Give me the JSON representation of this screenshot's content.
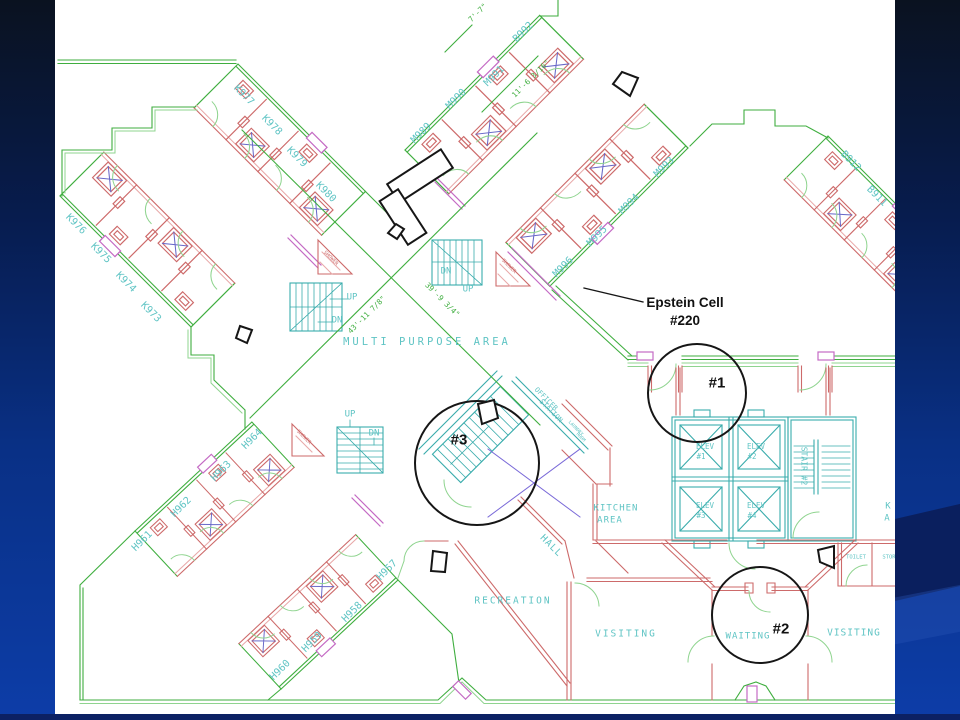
{
  "slide": {
    "bg_top": "#0a1220",
    "bg_mid": "#093085",
    "bg_bottom": "#0d3da8",
    "bottom_strip": "#0c2164",
    "plan_bg": "#ffffff"
  },
  "palette": {
    "cyan": "#5fc4c4",
    "red": "#cd6a6a",
    "green": "#3fae3f",
    "black": "#161616"
  },
  "annotations": {
    "epstein_line1": "Epstein Cell",
    "epstein_line2": "#220",
    "circle1_label": "#1",
    "circle2_label": "#2",
    "circle3_label": "#3"
  },
  "plan": {
    "labels": [
      {
        "t": "K977",
        "x": 244,
        "y": 95,
        "r": 45,
        "s": 10,
        "c": "cyan"
      },
      {
        "t": "K978",
        "x": 272,
        "y": 125,
        "r": 45,
        "s": 10,
        "c": "cyan"
      },
      {
        "t": "K979",
        "x": 297,
        "y": 157,
        "r": 45,
        "s": 10,
        "c": "cyan"
      },
      {
        "t": "K980",
        "x": 326,
        "y": 192,
        "r": 45,
        "s": 10,
        "c": "cyan"
      },
      {
        "t": "K976",
        "x": 76,
        "y": 224,
        "r": 45,
        "s": 10,
        "c": "cyan"
      },
      {
        "t": "K975",
        "x": 101,
        "y": 253,
        "r": 45,
        "s": 10,
        "c": "cyan"
      },
      {
        "t": "K974",
        "x": 126,
        "y": 282,
        "r": 45,
        "s": 10,
        "c": "cyan"
      },
      {
        "t": "K973",
        "x": 151,
        "y": 312,
        "r": 45,
        "s": 10,
        "c": "cyan"
      },
      {
        "t": "M989",
        "x": 421,
        "y": 133,
        "r": -45,
        "s": 10,
        "c": "cyan"
      },
      {
        "t": "M990",
        "x": 456,
        "y": 99,
        "r": -45,
        "s": 10,
        "c": "cyan"
      },
      {
        "t": "M991",
        "x": 494,
        "y": 76,
        "r": -45,
        "s": 10,
        "c": "cyan"
      },
      {
        "t": "B992",
        "x": 523,
        "y": 32,
        "r": -45,
        "s": 10,
        "c": "cyan"
      },
      {
        "t": "M993",
        "x": 664,
        "y": 167,
        "r": -45,
        "s": 10,
        "c": "cyan"
      },
      {
        "t": "M994",
        "x": 629,
        "y": 204,
        "r": -45,
        "s": 10,
        "c": "cyan"
      },
      {
        "t": "M995",
        "x": 597,
        "y": 236,
        "r": -45,
        "s": 10,
        "c": "cyan"
      },
      {
        "t": "M996",
        "x": 563,
        "y": 267,
        "r": -45,
        "s": 10,
        "c": "cyan"
      },
      {
        "t": "B912",
        "x": 851,
        "y": 161,
        "r": 45,
        "s": 10,
        "c": "cyan"
      },
      {
        "t": "B911",
        "x": 877,
        "y": 196,
        "r": 45,
        "s": 10,
        "c": "cyan"
      },
      {
        "t": "H964",
        "x": 252,
        "y": 439,
        "r": -45,
        "s": 10,
        "c": "cyan"
      },
      {
        "t": "H963",
        "x": 221,
        "y": 471,
        "r": -45,
        "s": 10,
        "c": "cyan"
      },
      {
        "t": "H962",
        "x": 181,
        "y": 507,
        "r": -45,
        "s": 10,
        "c": "cyan"
      },
      {
        "t": "H961",
        "x": 142,
        "y": 541,
        "r": -45,
        "s": 10,
        "c": "cyan"
      },
      {
        "t": "H957",
        "x": 387,
        "y": 570,
        "r": -45,
        "s": 10,
        "c": "cyan"
      },
      {
        "t": "H958",
        "x": 352,
        "y": 612,
        "r": -45,
        "s": 10,
        "c": "cyan"
      },
      {
        "t": "H959",
        "x": 312,
        "y": 642,
        "r": -45,
        "s": 10,
        "c": "cyan"
      },
      {
        "t": "H960",
        "x": 280,
        "y": 670,
        "r": -45,
        "s": 10,
        "c": "cyan"
      },
      {
        "t": "MULTI PURPOSE AREA",
        "x": 427,
        "y": 342,
        "r": 0,
        "s": 10.5,
        "c": "cyan",
        "ls": 3
      },
      {
        "t": "KITCHEN",
        "x": 616,
        "y": 508,
        "r": 0,
        "s": 9,
        "c": "cyan",
        "ls": 1
      },
      {
        "t": "AREA",
        "x": 610,
        "y": 520,
        "r": 0,
        "s": 9,
        "c": "cyan",
        "ls": 1
      },
      {
        "t": "K",
        "x": 888,
        "y": 506,
        "r": 0,
        "s": 9,
        "c": "cyan"
      },
      {
        "t": "A",
        "x": 887,
        "y": 518,
        "r": 0,
        "s": 9,
        "c": "cyan"
      },
      {
        "t": "HALL",
        "x": 551,
        "y": 546,
        "r": 45,
        "s": 9.5,
        "c": "cyan",
        "ls": 1
      },
      {
        "t": "RECREATION",
        "x": 513,
        "y": 601,
        "r": 0,
        "s": 9.5,
        "c": "cyan",
        "ls": 2
      },
      {
        "t": "VISITING",
        "x": 626,
        "y": 634,
        "r": 0,
        "s": 9.5,
        "c": "cyan",
        "ls": 2
      },
      {
        "t": "WAITING",
        "x": 748,
        "y": 636,
        "r": 0,
        "s": 9,
        "c": "cyan",
        "ls": 1
      },
      {
        "t": "VISITING",
        "x": 854,
        "y": 633,
        "r": 0,
        "s": 9.5,
        "c": "cyan",
        "ls": 1
      },
      {
        "t": "TOILET",
        "x": 856,
        "y": 557,
        "r": 0,
        "s": 5.5,
        "c": "cyan"
      },
      {
        "t": "STOR",
        "x": 889,
        "y": 557,
        "r": 0,
        "s": 5.5,
        "c": "cyan"
      },
      {
        "t": "ELEV",
        "x": 705,
        "y": 447,
        "r": 0,
        "s": 7.5,
        "c": "cyan"
      },
      {
        "t": "#1",
        "x": 701,
        "y": 457,
        "r": 0,
        "s": 7.5,
        "c": "cyan"
      },
      {
        "t": "ELEV",
        "x": 756,
        "y": 447,
        "r": 0,
        "s": 7.5,
        "c": "cyan"
      },
      {
        "t": "#2",
        "x": 752,
        "y": 457,
        "r": 0,
        "s": 7.5,
        "c": "cyan"
      },
      {
        "t": "ELEV",
        "x": 705,
        "y": 506,
        "r": 0,
        "s": 7.5,
        "c": "cyan"
      },
      {
        "t": "#3",
        "x": 701,
        "y": 516,
        "r": 0,
        "s": 7.5,
        "c": "cyan"
      },
      {
        "t": "ELEV",
        "x": 756,
        "y": 506,
        "r": 0,
        "s": 7.5,
        "c": "cyan"
      },
      {
        "t": "#4",
        "x": 752,
        "y": 516,
        "r": 0,
        "s": 7.5,
        "c": "cyan"
      },
      {
        "t": "STAIR #2",
        "x": 804,
        "y": 466,
        "r": 90,
        "s": 8,
        "c": "cyan"
      },
      {
        "t": "UP",
        "x": 352,
        "y": 297,
        "r": 0,
        "s": 9,
        "c": "cyan"
      },
      {
        "t": "DN",
        "x": 337,
        "y": 320,
        "r": 0,
        "s": 9,
        "c": "cyan"
      },
      {
        "t": "DN",
        "x": 446,
        "y": 271,
        "r": 0,
        "s": 9,
        "c": "cyan"
      },
      {
        "t": "UP",
        "x": 468,
        "y": 289,
        "r": 0,
        "s": 9,
        "c": "cyan"
      },
      {
        "t": "UP",
        "x": 350,
        "y": 414,
        "r": 0,
        "s": 9,
        "c": "cyan"
      },
      {
        "t": "DN",
        "x": 374,
        "y": 433,
        "r": 0,
        "s": 9,
        "c": "cyan"
      },
      {
        "t": "OFFICER",
        "x": 546,
        "y": 399,
        "r": 45,
        "s": 7,
        "c": "cyan"
      },
      {
        "t": "STATION",
        "x": 551,
        "y": 411,
        "r": 45,
        "s": 7,
        "c": "cyan"
      },
      {
        "t": "LAUNDRY",
        "x": 576,
        "y": 428,
        "r": 45,
        "s": 4.5,
        "c": "cyan"
      },
      {
        "t": "ROOM",
        "x": 581,
        "y": 437,
        "r": 45,
        "s": 4.5,
        "c": "cyan"
      },
      {
        "t": "SHOWER",
        "x": 331,
        "y": 258,
        "r": 45,
        "s": 5,
        "c": "red"
      },
      {
        "t": "SHOWER",
        "x": 509,
        "y": 266,
        "r": 45,
        "s": 5,
        "c": "red"
      },
      {
        "t": "SHOWER",
        "x": 304,
        "y": 437,
        "r": 45,
        "s": 5,
        "c": "red"
      },
      {
        "t": "43'-11 7/8\"",
        "x": 367,
        "y": 315,
        "r": -45,
        "s": 7.5,
        "c": "green"
      },
      {
        "t": "39'-9 3/4\"",
        "x": 442,
        "y": 300,
        "r": 45,
        "s": 7.5,
        "c": "green"
      },
      {
        "t": "7'-7\"",
        "x": 478,
        "y": 13,
        "r": -45,
        "s": 7.5,
        "c": "green"
      },
      {
        "t": "11'-6 3/16\"",
        "x": 531,
        "y": 79,
        "r": -45,
        "s": 7.5,
        "c": "green"
      }
    ]
  }
}
